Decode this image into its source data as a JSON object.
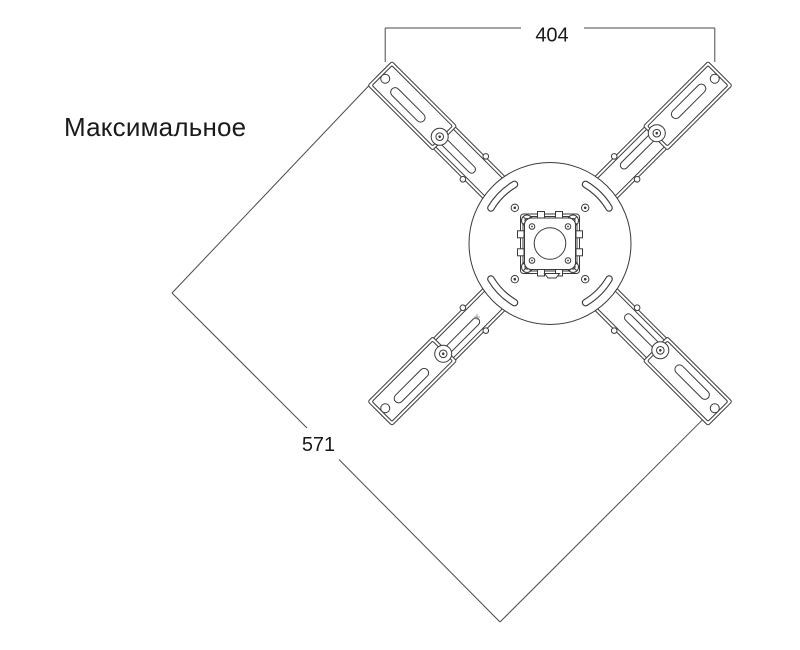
{
  "labels": {
    "note": "Максимальное"
  },
  "dimensions": {
    "top_width": "404",
    "diagonal": "571"
  },
  "colors": {
    "line": "#3a3a3a",
    "dim_line": "#4a4a4a",
    "text": "#1a1a1a",
    "background": "#ffffff"
  }
}
